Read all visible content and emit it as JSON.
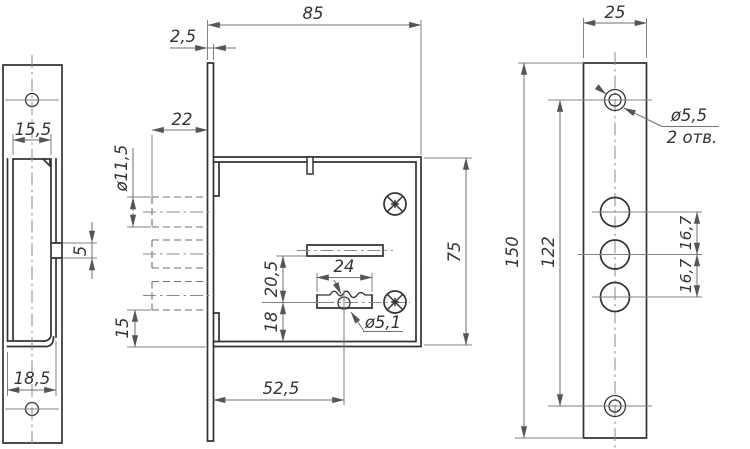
{
  "drawing_type": "lock-technical-drawing",
  "colors": {
    "background": "#ffffff",
    "contour_line": "#333333",
    "thin_line": "#828282",
    "text": "#333333"
  },
  "views": {
    "strike_plate_side": {
      "labels": {
        "slot_width_top": "15,5",
        "lip_depth": "5",
        "slot_width_bottom": "18,5"
      }
    },
    "lock_body_side": {
      "labels": {
        "overall_depth": "85",
        "faceplate_thickness": "2,5",
        "bolt_throw": "22",
        "bolt_diameter": "ø11,5",
        "bolt_to_bottom": "15",
        "case_height": "75",
        "keyhole_center_offset": "52,5",
        "key_bit_width": "24",
        "latch_to_keyhole": "20,5",
        "keyhole_to_bottom": "18",
        "keyhole_diameter": "ø5,1"
      }
    },
    "faceplate_front": {
      "labels": {
        "plate_width": "25",
        "plate_height": "150",
        "screw_hole_spacing": "122",
        "bolt_hole_pitch_upper": "16,7",
        "bolt_hole_pitch_lower": "16,7",
        "screw_hole_diameter": "ø5,5",
        "screw_hole_quantity": "2 отв."
      }
    }
  }
}
